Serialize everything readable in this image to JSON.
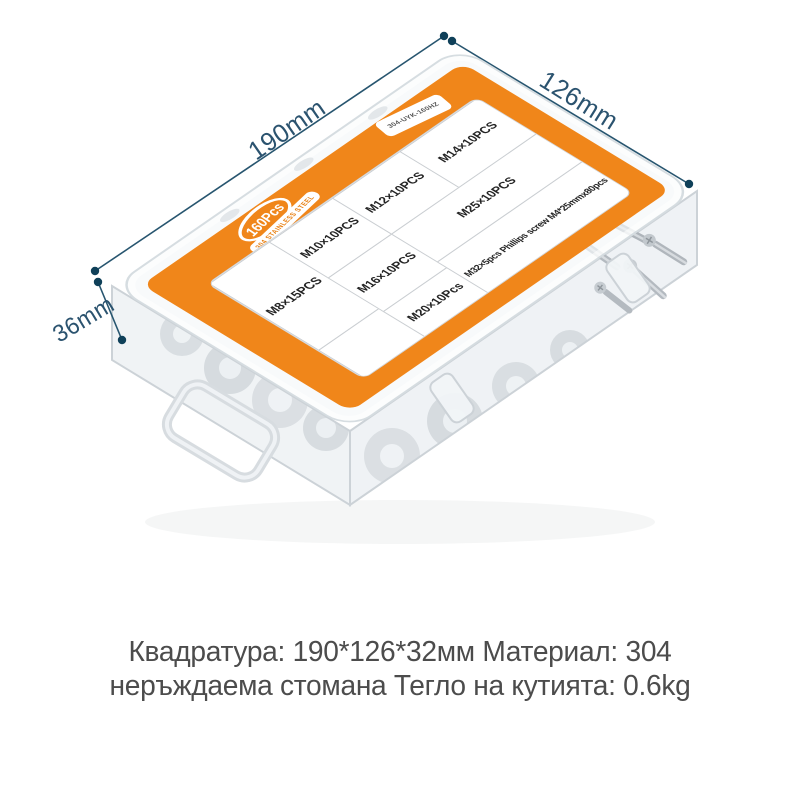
{
  "product": {
    "badge": "160Pcs",
    "badge_sub": "304 STAINLESS STEEL",
    "corner_label": "304-UYK-160HZ",
    "compartments": [
      "M8×15PCS",
      "M10×10PCS",
      "M12×10PCS",
      "M14×10PCS",
      "M16×10PCS",
      "M20×10Pcs",
      "M25×10PCS",
      "M32×5pcs  Phillips screw  M4*25mmx80pcs"
    ]
  },
  "dimensions": {
    "length": "190mm",
    "width": "126mm",
    "height": "36mm"
  },
  "caption": {
    "line1": "Квадратура: 190*126*32мм Материал: 304",
    "line2": "неръждаема стомана Тегло на кутията: 0.6kg"
  },
  "colors": {
    "accent_orange": "#f0861a",
    "dimension_blue": "#2b536f",
    "caption_gray": "#4c4c4c"
  }
}
